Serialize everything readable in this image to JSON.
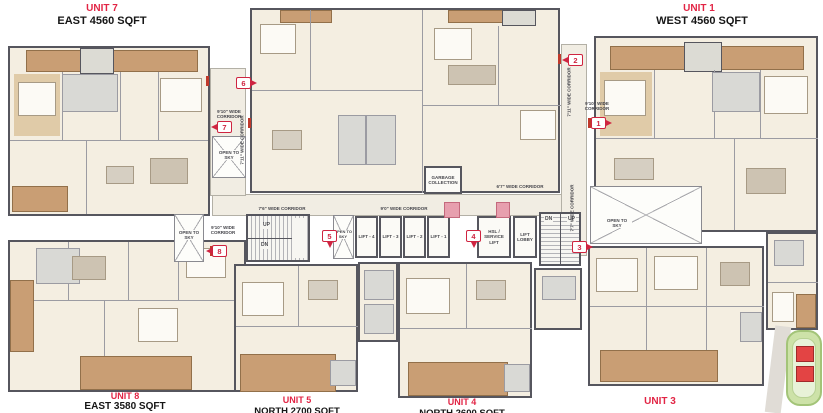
{
  "colors": {
    "accent_red": "#e22545",
    "marker_red": "#cf2440",
    "wall_gray": "#56565e",
    "deck_tan": "#c99e74",
    "floor_cream": "#f4eee1",
    "keyplan_green": "#cde2a8",
    "keyplan_building_red": "#e34444"
  },
  "units": {
    "unit7": {
      "name": "UNIT 7",
      "area": "EAST 4560 SQFT"
    },
    "unit1": {
      "name": "UNIT 1",
      "area": "WEST 4560 SQFT"
    },
    "unit8": {
      "name": "UNIT 8",
      "area": "EAST 3580 SQFT"
    },
    "unit5": {
      "name": "UNIT 5",
      "area": "NORTH 2700 SQFT"
    },
    "unit4": {
      "name": "UNIT 4",
      "area": "NORTH 2600 SQFT"
    },
    "unit3": {
      "name": "UNIT 3"
    }
  },
  "markers": {
    "m1": "1",
    "m2": "2",
    "m3": "3",
    "m4": "4",
    "m5": "5",
    "m6": "6",
    "m7": "7",
    "m8": "8"
  },
  "corridors": {
    "w910": "9'10\" WIDE CORRIDOR",
    "w711": "7'11\" WIDE CORRIDOR",
    "w76": "7'6\" WIDE CORRIDOR",
    "w90": "9'0\" WIDE CORRIDOR",
    "w67": "6'7\" WIDE CORRIDOR",
    "w77": "7'7\" WIDE CORRIDOR"
  },
  "core": {
    "garbage": "GARBAGE COLLECTION",
    "lifts": [
      "LIFT - 4",
      "LIFT - 3",
      "LIFT - 2",
      "LIFT - 1"
    ],
    "service_lift": "HSL / SERVICE LIFT",
    "lift_lobby": "LIFT LOBBY",
    "up": "UP",
    "dn": "DN",
    "open_to_sky": "OPEN TO SKY"
  }
}
